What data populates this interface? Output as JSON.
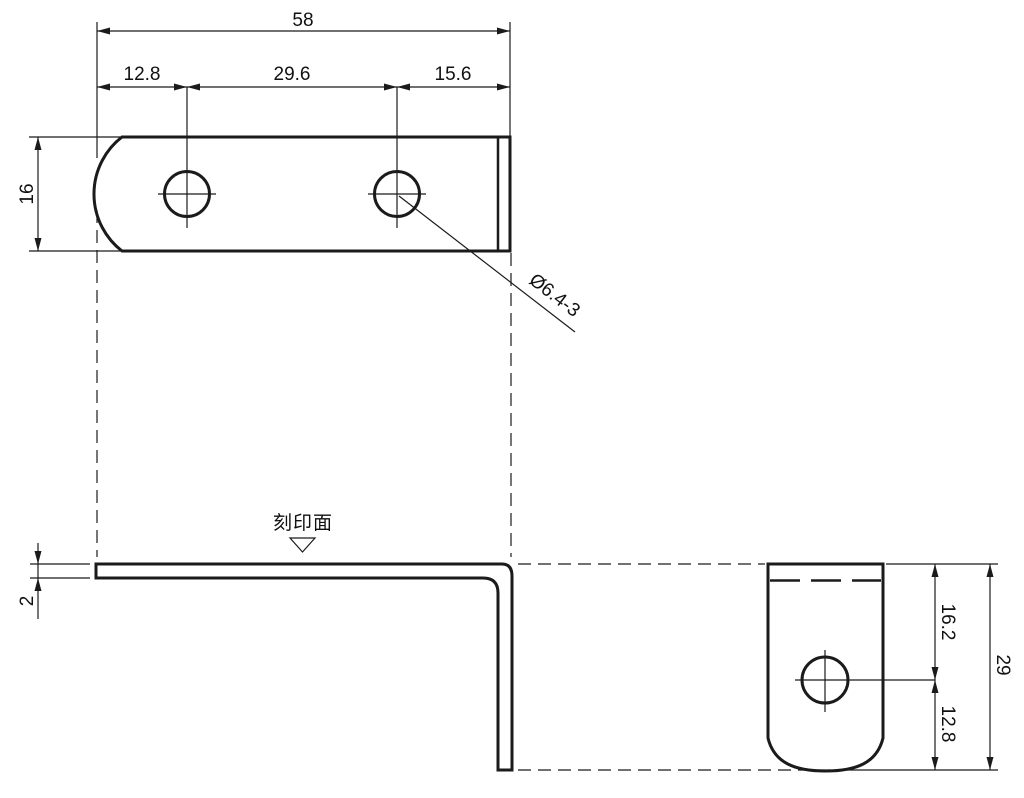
{
  "drawing": {
    "type": "engineering-drawing",
    "line_color": "#1b1b1b",
    "background": "#ffffff",
    "top_view": {
      "dim_total_width": "58",
      "dim_left_to_hole1": "12.8",
      "dim_hole_spacing": "29.6",
      "dim_hole2_to_right": "15.6",
      "dim_plate_width": "16",
      "hole_callout": "Ø6.4-3"
    },
    "front_view": {
      "dim_thickness": "2",
      "marking_surface_label": "刻印面"
    },
    "side_view": {
      "dim_top_to_hole": "16.2",
      "dim_hole_to_bottom": "12.8",
      "dim_leg_height": "29"
    }
  }
}
